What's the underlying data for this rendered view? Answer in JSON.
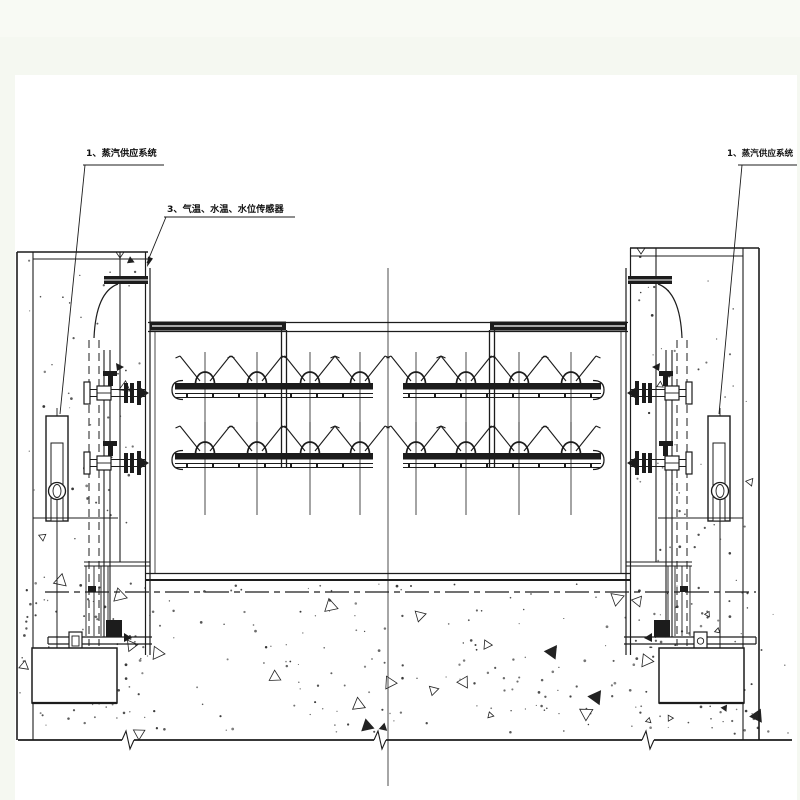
{
  "page": {
    "background": "#f5f8f1",
    "paper": "#ffffff",
    "ink": "#1c1c1c"
  },
  "labels": {
    "left_steam": "1、蒸汽供应系统",
    "sensors": "3、气温、水温、水位传感器",
    "right_steam": "1、蒸汽供应系统"
  }
}
